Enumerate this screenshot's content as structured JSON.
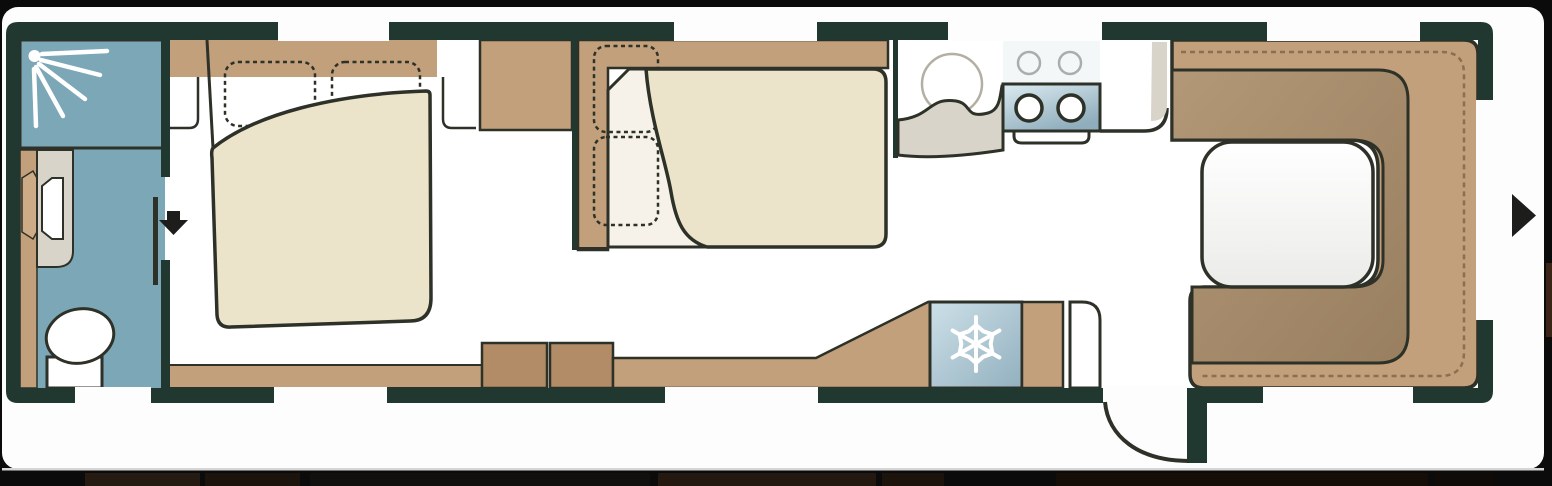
{
  "meta": {
    "kind": "caravan-floor-plan",
    "description": "Top-view caravan layout drawing, no text labels visible"
  },
  "colors": {
    "canvas": "#0b0b0b",
    "card": "#fdfdfe",
    "wall": "#213830",
    "outline": "#2d3128",
    "floor": "#ffffff",
    "tan": "#c2a07b",
    "tan_light": "#cdab86",
    "tan_dark": "#b18c66",
    "backrest_light": "#b39877",
    "backrest_dark": "#987f5f",
    "cream": "#ece3cb",
    "seat": "#f6f2e9",
    "blue": "#7ca7b6",
    "fridge_light": "#cde0e8",
    "fridge_dark": "#92b0bf",
    "hob_light": "#dcebf1",
    "hob_dark": "#8fadbc",
    "grey": "#d9d4c9",
    "stitch": "#8a6f52",
    "icon": "#1d1d1b",
    "table_light": "#ffffff",
    "table_dark": "#ebebe9",
    "sink_stroke": "#b4afa3",
    "hob_ring": "#a8aeae",
    "strip_line": "#d6d6d6"
  },
  "icons": [
    "shower-spray-icon",
    "door-arrow-down-icon",
    "snowflake-icon",
    "entrance-arrow-right-icon"
  ],
  "rooms": [
    "washroom-shower",
    "washroom-toilet-vanity",
    "front-double-bed",
    "wardrobe",
    "dinette-with-table",
    "kitchen-sink-and-hob",
    "refrigerator",
    "rear-u-lounge-with-table",
    "side-entrance-door"
  ],
  "openings": {
    "top_windows": 4,
    "bottom_windows": 3,
    "rear_window": 1,
    "entry_door": 1
  }
}
